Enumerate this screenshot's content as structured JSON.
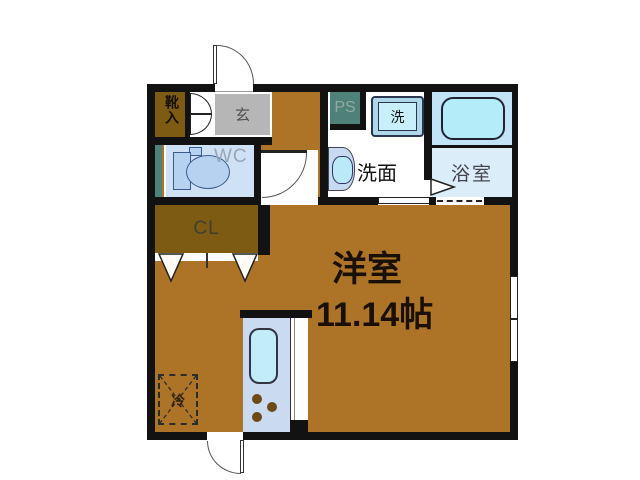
{
  "floorplan": {
    "type": "apartment-floor-plan",
    "labels": {
      "shoe_cabinet": "靴入",
      "entrance": "玄",
      "wc": "WC",
      "pipe_space": "PS",
      "washing_machine": "洗",
      "washroom": "洗面",
      "bathroom": "浴室",
      "closet": "CL",
      "main_room": "洋室",
      "main_room_size": "11.14帖",
      "refrigerator": "冷"
    },
    "colors": {
      "floor_wood": "#ad7428",
      "storage_dark_brown": "#7d5b12",
      "entrance_gray": "#b6b6b6",
      "pipe_space_teal": "#4e8177",
      "wc_floor_blue": "#cfe1f5",
      "kitchen_counter_blue": "#c9daf1",
      "fixture_cyan": "#bfeaf6",
      "bath_upper_blue": "#c2e4f7",
      "bath_lower_blue": "#dcedfa",
      "wall_black": "#121212"
    }
  }
}
